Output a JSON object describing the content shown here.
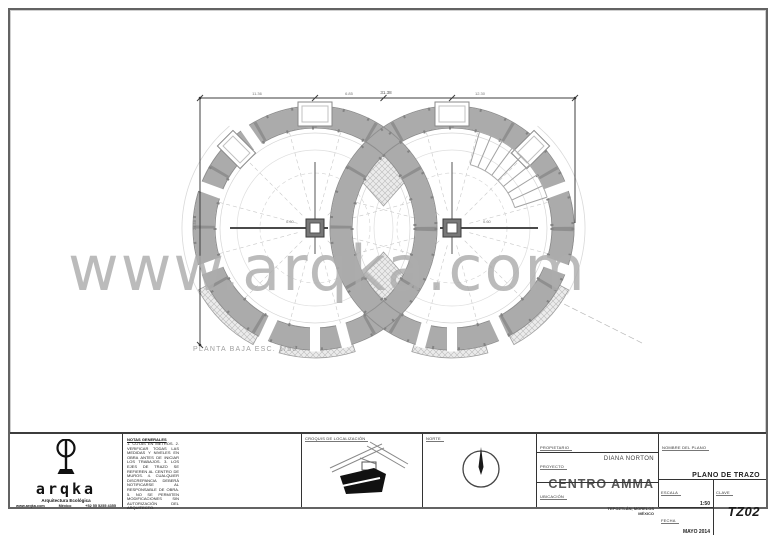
{
  "watermark": "www.arqka.com",
  "plan": {
    "caption": "PLANTA BAJA  ESC. 1/50",
    "dims": {
      "total": "31.38",
      "seg_left": "11.36",
      "seg_mid": "6.85",
      "seg_right": "12.30",
      "height": "24.58",
      "center": "0.60"
    }
  },
  "titleblock": {
    "logo": {
      "name": "arqka",
      "tagline": "Arquitectura Ecológica",
      "contact_web": "www.arqka.com",
      "contact_city": "México",
      "contact_phone": "+52 55 5255 4355"
    },
    "notes": {
      "title": "NOTAS GENERALES",
      "body": "1. COTAS EN METROS. 2. VERIFICAR TODAS LAS MEDIDAS Y NIVELES EN OBRA ANTES DE INICIAR LOS TRABAJOS. 3. LOS EJES DE TRAZO SE REFIEREN AL CENTRO DE MUROS. 4. CUALQUIER DISCREPANCIA DEBERÁ NOTIFICARSE AL RESPONSABLE DE OBRA. 5. NO SE PERMITEN MODIFICACIONES SIN AUTORIZACIÓN DEL ARQUITECTO."
    },
    "croquis": {
      "label": "CROQUIS DE LOCALIZACIÓN"
    },
    "north": {
      "label": "NORTE"
    },
    "info": {
      "owner_label": "PROPIETARIO",
      "owner": "DIANA NORTON",
      "project_label": "PROYECTO",
      "project": "CENTRO AMMA",
      "location_label": "UBICACIÓN",
      "location_line1": "TEPOZTLÁN, MORELOS",
      "location_line2": "MÉXICO"
    },
    "sheet": {
      "name_label": "NOMBRE DEL PLANO",
      "name": "PLANO DE TRAZO",
      "scale_label": "ESCALA",
      "scale": "1:50",
      "date_label": "FECHA",
      "date": "MAYO 2014",
      "key_label": "CLAVE",
      "key": "TZ02"
    }
  }
}
